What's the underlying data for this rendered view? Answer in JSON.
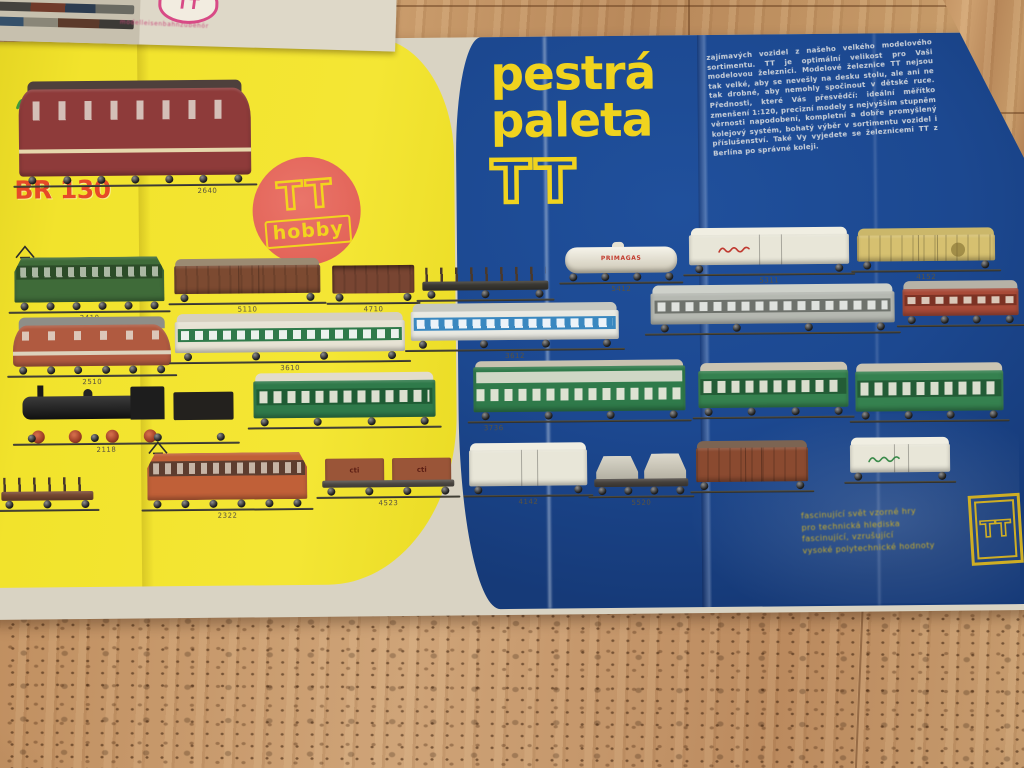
{
  "insert": {
    "logo_tt": "TT",
    "caption": "modelleisenbahnzubehör"
  },
  "poster": {
    "title": [
      "pestrá",
      "paleta",
      "TT"
    ],
    "intro": "zajímavých vozidel z našeho velkého modelového sortimentu. TT je optimální velikost pro Vaši modelovou železnici. Modelové železnice TT nejsou tak velké, aby se nevešly na desku stolu, ale ani ne tak drobné, aby nemohly spočinout v dětské ruce. Přednosti, které Vás přesvědčí: ideální měřítko zmenšení 1:120, precizní modely s nejvyšším stupněm věrnosti napodobení, kompletní a dobře promyšlený kolejový systém, bohatý výběr v sortimentu vozidel i příslušenství. Také Vy vyjedete se železnicemi TT z Berlína po správné koleji.",
    "left": {
      "brand_label": "BR 130",
      "tt_hobby_top": "TT",
      "tt_hobby_bottom": "hobby"
    },
    "footer_lines": [
      "fascinující svět vzorné hry",
      "pro technická hlediska",
      "fascinující, vzrušující",
      "vysoké polytechnické hodnoty"
    ],
    "corner_logo": "TT"
  },
  "fleet": [
    {
      "id": "br130",
      "number": "2640"
    },
    {
      "id": "loco_electric_green",
      "number": "2410"
    },
    {
      "id": "loco_diesel_red",
      "number": "2510"
    },
    {
      "id": "loco_steam",
      "number": "2118"
    },
    {
      "id": "wagon_stake_left",
      "number": ""
    },
    {
      "id": "boxcar_brown",
      "number": "5110"
    },
    {
      "id": "open_wagon",
      "number": "4710"
    },
    {
      "id": "flat_stake_black",
      "number": "4610"
    },
    {
      "id": "tank_car",
      "number": "5412",
      "brand": "PRIMAGAS"
    },
    {
      "id": "reefer_script",
      "number": "5311"
    },
    {
      "id": "boxcar_yellow",
      "number": "4152"
    },
    {
      "id": "coach_green_band",
      "number": "3610"
    },
    {
      "id": "coach_blue_band",
      "number": "3612"
    },
    {
      "id": "coach_silver",
      "number": ""
    },
    {
      "id": "coach_red",
      "number": ""
    },
    {
      "id": "coach_green_mail",
      "number": ""
    },
    {
      "id": "coach_double_deck",
      "number": "3736"
    },
    {
      "id": "coach_green_b",
      "number": ""
    },
    {
      "id": "coach_green_c",
      "number": ""
    },
    {
      "id": "loco_electric_orange",
      "number": "2322"
    },
    {
      "id": "container_car",
      "number": "4523",
      "brand": "cti"
    },
    {
      "id": "reefer_white",
      "number": "4142"
    },
    {
      "id": "hopper_pair",
      "number": "5520"
    },
    {
      "id": "boxcar_brown_b",
      "number": ""
    },
    {
      "id": "boxcar_green_script",
      "number": ""
    }
  ],
  "colors": {
    "poster_blue": "#1d4b92",
    "poster_yellow": "#f0e12c",
    "title_yellow": "#f0d31e",
    "accent_red": "#e64a28",
    "hobby_salmon": "#e4695c",
    "logo_pink": "#d84a86"
  }
}
